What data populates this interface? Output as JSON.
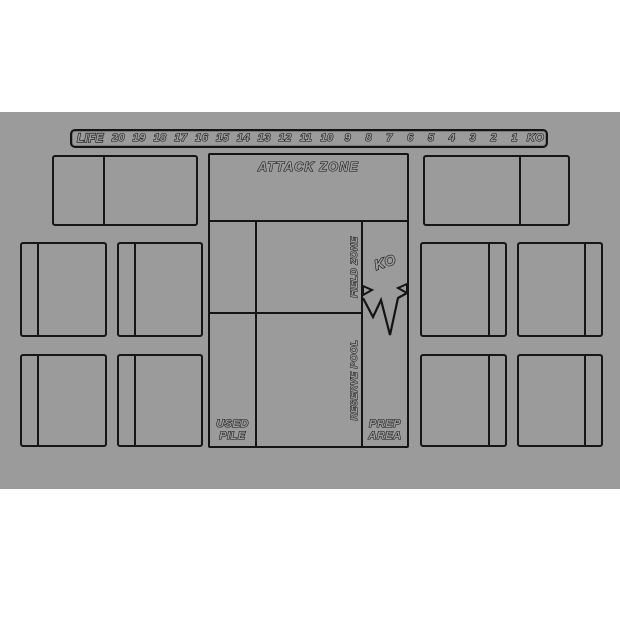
{
  "title": "card game playmat",
  "colors": {
    "background": "#ffffff",
    "mat": "#9b9b9b",
    "line": "#161616"
  },
  "life_track": {
    "label": "LIFE",
    "values": [
      "20",
      "19",
      "18",
      "17",
      "16",
      "15",
      "14",
      "13",
      "12",
      "11",
      "10",
      "9",
      "8",
      "7",
      "6",
      "5",
      "4",
      "3",
      "2",
      "1",
      "KO"
    ]
  },
  "zones": {
    "attack_zone_label": "ATTACK ZONE",
    "field_zone_label": "FIELD ZONE",
    "reserve_pool_label": "RESERVE POOL",
    "ko_label": "KO",
    "used_pile_label": "USED\nPILE",
    "prep_area_label": "PREP\nAREA"
  }
}
